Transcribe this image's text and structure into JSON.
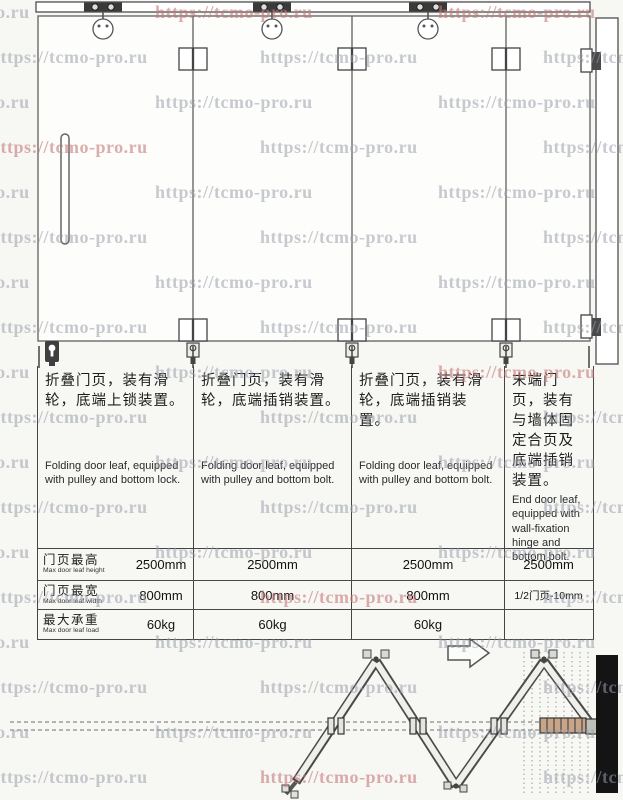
{
  "watermark": {
    "text": "https://tcmo-pro.ru",
    "gray": "#9aa0ab",
    "red": "#c47a7a",
    "items": [
      [
        -128,
        2
      ],
      [
        155,
        2,
        1
      ],
      [
        438,
        2,
        1
      ],
      [
        -10,
        47
      ],
      [
        260,
        47
      ],
      [
        543,
        47
      ],
      [
        -128,
        92
      ],
      [
        155,
        92
      ],
      [
        438,
        92
      ],
      [
        -10,
        137,
        1
      ],
      [
        260,
        137
      ],
      [
        543,
        137
      ],
      [
        -128,
        182
      ],
      [
        155,
        182
      ],
      [
        438,
        182
      ],
      [
        -10,
        227
      ],
      [
        260,
        227
      ],
      [
        543,
        227
      ],
      [
        -128,
        272
      ],
      [
        155,
        272
      ],
      [
        438,
        272
      ],
      [
        -10,
        317
      ],
      [
        260,
        317
      ],
      [
        543,
        317
      ],
      [
        -128,
        362
      ],
      [
        155,
        362
      ],
      [
        438,
        362,
        1
      ],
      [
        -10,
        407
      ],
      [
        260,
        407
      ],
      [
        543,
        407
      ],
      [
        -128,
        452
      ],
      [
        155,
        452
      ],
      [
        438,
        452
      ],
      [
        -10,
        497
      ],
      [
        260,
        497
      ],
      [
        543,
        497
      ],
      [
        -128,
        542
      ],
      [
        155,
        542
      ],
      [
        438,
        542
      ],
      [
        -10,
        587
      ],
      [
        260,
        587,
        1
      ],
      [
        543,
        587
      ],
      [
        -128,
        632
      ],
      [
        155,
        632
      ],
      [
        438,
        632
      ],
      [
        -10,
        677
      ],
      [
        260,
        677
      ],
      [
        543,
        677
      ],
      [
        -128,
        722
      ],
      [
        155,
        722
      ],
      [
        438,
        722
      ],
      [
        -10,
        767
      ],
      [
        260,
        767,
        1
      ],
      [
        543,
        767
      ]
    ]
  },
  "columns": [
    {
      "cn": "折叠门页，装有滑轮，底端上锁装置。",
      "en": "Folding door leaf, equipped with pulley and bottom lock."
    },
    {
      "cn": "折叠门页，装有滑轮，底端插销装置。",
      "en": "Folding door leaf, equipped with pulley and bottom bolt."
    },
    {
      "cn": "折叠门页，装有滑轮，底端插销装置。",
      "en": "Folding door leaf, equipped with pulley and bottom bolt."
    },
    {
      "cn": "末端门页，装有与墙体固定合页及底端插销装置。",
      "en": "End door leaf, equipped with wall-fixation hinge and bottom bolt."
    }
  ],
  "spec_table": {
    "rows": [
      {
        "label_cn": "门页最高",
        "label_en": "Max door leaf height",
        "values": [
          "2500mm",
          "2500mm",
          "2500mm",
          "2500mm"
        ]
      },
      {
        "label_cn": "门页最宽",
        "label_en": "Max door leaf width",
        "values": [
          "800mm",
          "800mm",
          "800mm",
          "1/2门页-10mm"
        ]
      },
      {
        "label_cn": "最大承重",
        "label_en": "Max door leaf load",
        "values": [
          "60kg",
          "60kg",
          "60kg",
          ""
        ]
      }
    ]
  },
  "plan": {
    "wall_color": "#141414",
    "stack_color": "#c8a488",
    "line_color": "#4a4a4a"
  }
}
